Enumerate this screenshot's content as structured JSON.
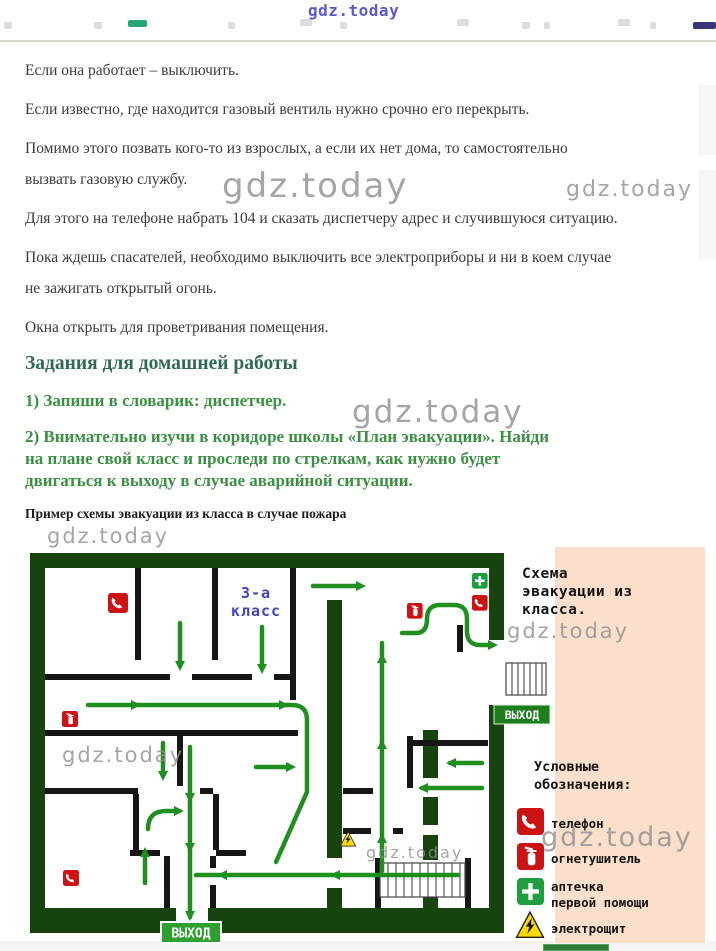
{
  "watermark": {
    "text": "gdz.today"
  },
  "colors": {
    "accent_task_green": "#3a9142",
    "heading_green": "#2f6b50",
    "plan_border_green": "#17430e",
    "arrow_green": "#1f8f1f",
    "exit_sign_green": "#2fa02f",
    "legend_panel_pink": "#fbdfca",
    "icon_red": "#cc1212",
    "icon_green": "#1f9e3f",
    "warning_yellow": "#ffd900",
    "room_label_blue": "#4343c8",
    "watermark_gray": "#8f8f8f",
    "watermark_blue": "#4848cf"
  },
  "article": {
    "paragraphs": [
      {
        "lines": [
          "Если она работает – выключить."
        ]
      },
      {
        "lines": [
          "Если известно, где находится газовый вентиль нужно срочно его перекрыть."
        ]
      },
      {
        "lines": [
          "Помимо этого позвать кого-то из взрослых, а если их нет дома, то самостоятельно",
          "вызвать газовую службу."
        ]
      },
      {
        "lines": [
          "Для этого на телефоне набрать 104 и сказать диспетчеру адрес и случившуюся ситуацию."
        ]
      },
      {
        "lines": [
          "Пока ждешь спасателей, необходимо выключить все электроприборы и ни в коем случае",
          "не зажигать открытый огонь."
        ]
      },
      {
        "lines": [
          "Окна открыть для проветривания помещения."
        ]
      }
    ],
    "heading": "Задания для домашней работы",
    "tasks": [
      {
        "lines": [
          "1) Запиши в словарик: диспетчер."
        ]
      },
      {
        "lines": [
          "2) Внимательно изучи в коридоре школы «План эвакуации». Найди",
          "на плане свой класс и проследи по стрелкам, как нужно будет",
          "двигаться к выходу в случае аварийной ситуации."
        ]
      }
    ],
    "caption": "Пример схемы эвакуации из класса в случае пожара"
  },
  "plan": {
    "room_label": [
      "3-а",
      "класс"
    ],
    "exit_label": "ВЫХОД",
    "title_lines": [
      "Схема",
      "эвакуации из",
      "класса."
    ],
    "legend": {
      "title_lines": [
        "Условные",
        "обозначения:"
      ],
      "items": [
        {
          "icon": "phone-icon",
          "lines": [
            "телефон"
          ]
        },
        {
          "icon": "fire-extinguisher-icon",
          "lines": [
            "огнетушитель"
          ]
        },
        {
          "icon": "first-aid-icon",
          "lines": [
            "аптечка",
            "первой помощи"
          ]
        },
        {
          "icon": "electric-panel-icon",
          "lines": [
            "электрощит"
          ]
        }
      ]
    }
  }
}
